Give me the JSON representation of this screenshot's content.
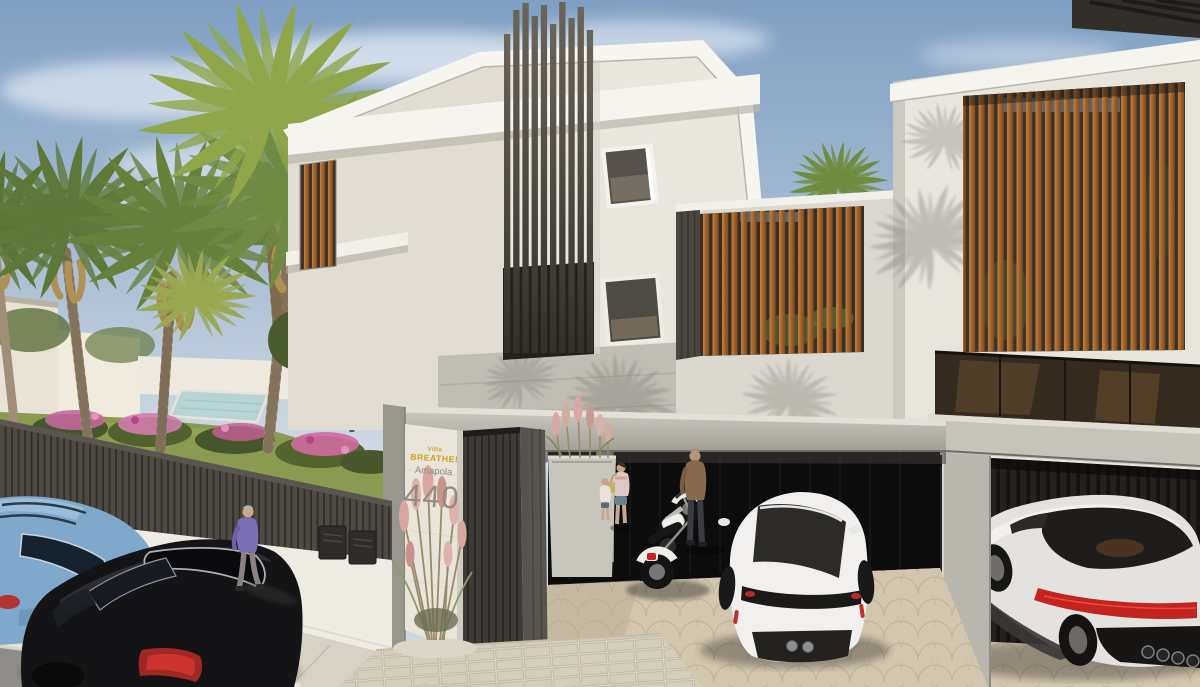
{
  "image": {
    "kind": "3d-architectural-render",
    "subject": "Modern white villa street elevation with carports, palm garden, parked cars, motorcycle and pedestrians",
    "width_px": 1200,
    "height_px": 687
  },
  "signage": {
    "villa_prefix": "Villa",
    "villa_name": "BREATHE!",
    "street_name": "Amapola",
    "house_number": "440"
  },
  "palette": {
    "sky_top": "#7fa0c4",
    "sky_horizon": "#d3dce5",
    "wall_white": "#e9e6de",
    "wall_bright": "#f7f5f0",
    "concrete_band": "#c0bdb5",
    "concrete_beam": "#bab7af",
    "timber_slat": "#a2622a",
    "dark_slat": "#45403a",
    "garage_door": "#0c0c0c",
    "lawn_green": "#8a9a50",
    "flower_pink": "#c96b9b",
    "palm_green": "#6f8a42",
    "car_blue": "#7fa9cc",
    "car_black": "#141417",
    "porsche_white": "#f1f0ee",
    "supercar_white": "#e4e2de",
    "taillight_red": "#c42420",
    "sign_yellow": "#d4a017",
    "sign_gray": "#8d897f",
    "cobble_floor": "#d2c6af",
    "sidewalk": "#d7d1c6",
    "asphalt": "#8f8d8a"
  },
  "objects": {
    "buildings": [
      "main-villa",
      "right-villa",
      "left-wing",
      "distant-house"
    ],
    "vehicles": [
      "blue-estate-car",
      "black-estate-car",
      "white-porsche-coupe",
      "white-supercar",
      "classic-motorcycle"
    ],
    "people": [
      "woman-walking-sidewalk",
      "man-by-motorcycle",
      "woman-with-bag",
      "child"
    ],
    "vegetation": [
      "fan-palm-trees",
      "garden-tree",
      "pink-flower-bushes",
      "ornamental-grasses",
      "lawn"
    ]
  }
}
